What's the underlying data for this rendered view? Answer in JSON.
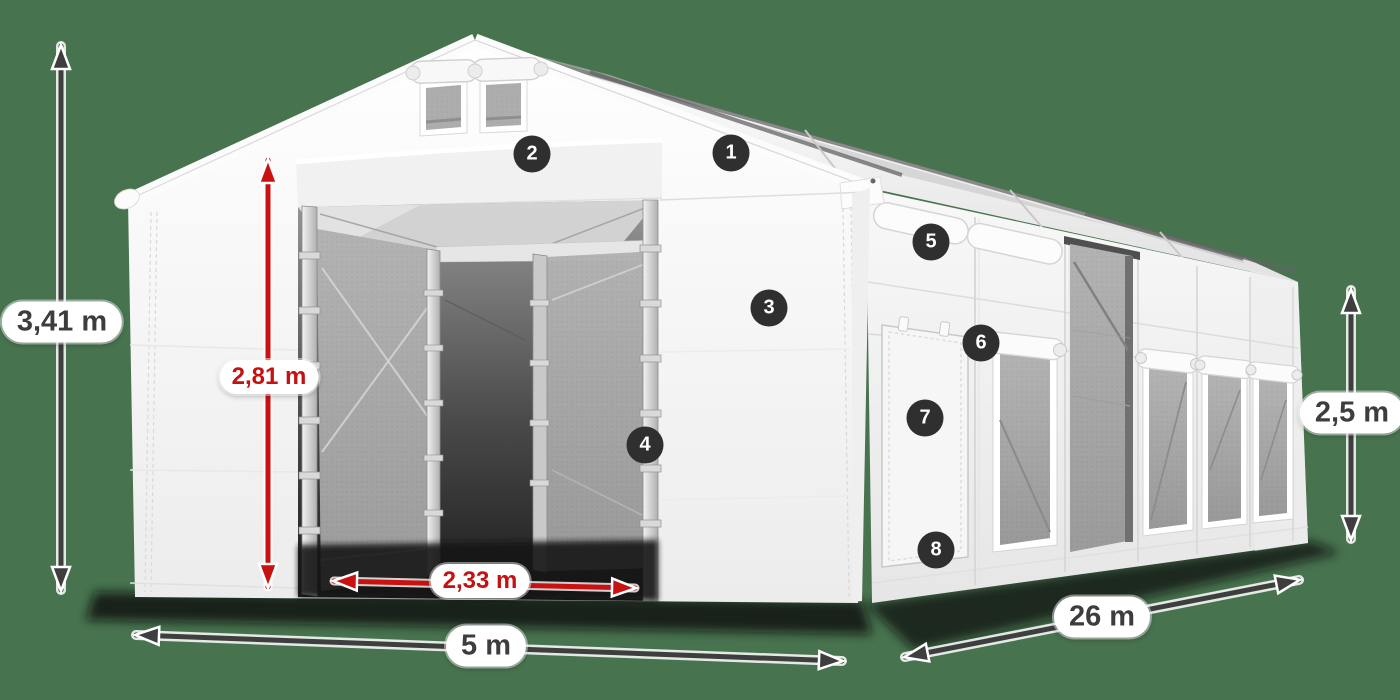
{
  "scene": {
    "background_color": "#48734f"
  },
  "dimensions": {
    "total_height": {
      "label": "3,41 m",
      "color": "#3d3d3d"
    },
    "inner_height": {
      "label": "2,81 m",
      "color": "#c41212"
    },
    "door_width": {
      "label": "2,33 m",
      "color": "#c41212"
    },
    "width": {
      "label": "5 m",
      "color": "#3d3d3d"
    },
    "length": {
      "label": "26 m",
      "color": "#3d3d3d"
    },
    "side_height": {
      "label": "2,5 m",
      "color": "#3d3d3d"
    }
  },
  "feature_markers": [
    "1",
    "2",
    "3",
    "4",
    "5",
    "6",
    "7",
    "8"
  ],
  "palette": {
    "arrow_dark": "#3e3e3e",
    "arrow_red": "#c91111",
    "label_background": "#ffffff",
    "badge_background": "#2f2f2f",
    "badge_text": "#ffffff",
    "tent_fabric": "#f4f4f4",
    "mesh_gray": "#a5a5a5"
  }
}
